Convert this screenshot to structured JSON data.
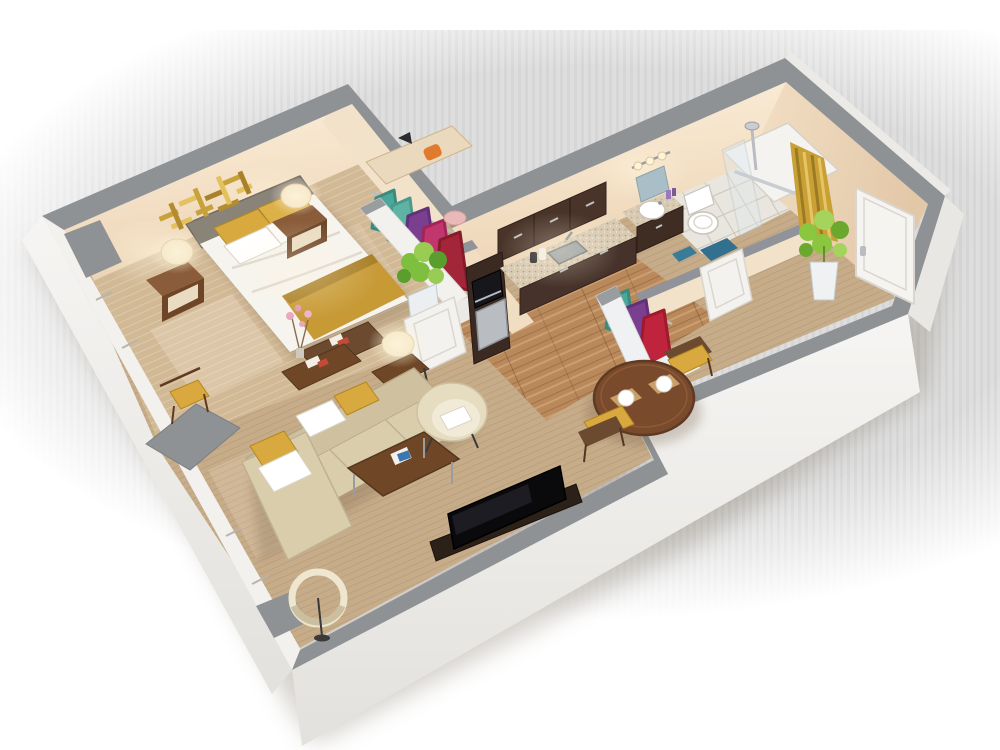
{
  "scene": {
    "type": "3d-floorplan-cutaway-render",
    "subject": "one-bedroom apartment isometric dollhouse view",
    "background": "soft vertical-striped light gray backdrop fading to white at edges",
    "view": "elevated three-quarter view from the south-east, walls cut low on viewer side"
  },
  "palette": {
    "wall_top_gray": "#8f9295",
    "wall_inner_cream": "#f6e7d2",
    "wall_outer_white": "#f2f0ed",
    "carpet_tan": "#c7ac89",
    "bedroom_carpet": "#d2b996",
    "wood_floor": "#b9895c",
    "bathroom_tile": "#e9e6df",
    "cabinet_espresso": "#402e25",
    "counter_speckled": "#d9cab2",
    "accent_gold": "#c9a23c",
    "duvet_white": "#f6f4ef",
    "headboard_gray": "#8a8378",
    "sofa_beige": "#d9cdac",
    "walnut_wood": "#6f4626",
    "lamp_cream": "#f3e3c2",
    "chair_mustard": "#d9a93f",
    "garment_teal": "#4aa89a",
    "garment_purple": "#7b3f8f",
    "garment_magenta": "#c2366e",
    "garment_crimson": "#a32638",
    "plant_green": "#7fbf3f",
    "bath_mat_blue": "#31708e",
    "shower_curtain_gold": "#c9a035"
  },
  "rooms": [
    {
      "name": "bedroom",
      "floor": "tan carpet with light weave",
      "furniture": [
        "queen bed with gray headboard, white duvet, gold runner, two gold and two white pillows",
        "left nightstand with cream table lamp",
        "right nightstand with cream table lamp",
        "gold abstract metal wall art above headboard",
        "walnut foot bench with books",
        "small desk stool with gold cushion by window",
        "vase of pink blossom branches"
      ]
    },
    {
      "name": "bedroom-closet",
      "furniture": [
        "cream shelf with orange handbag and black clutch",
        "clothes rail with teal, purple, magenta and crimson garments",
        "pink sun hat",
        "white half-height partitions",
        "potted green plant in white pot"
      ]
    },
    {
      "name": "living-room",
      "floor": "tan carpet",
      "furniture": [
        "beige L-shaped sectional sofa with chaise, white and gold pillows",
        "walnut coffee table with chrome legs and magazines",
        "cream barrel armchair with white pillow",
        "walnut side table with cream lamp",
        "walnut console with books",
        "flat-screen TV on dark media bench",
        "cream ring floor lamp in corner"
      ]
    },
    {
      "name": "kitchenette",
      "floor": "light oak plank wood",
      "furniture": [
        "espresso upper cabinets",
        "espresso base cabinets with speckled counter",
        "stainless undermount sink with faucet",
        "built-in black microwave",
        "stainless-front refrigerator drawer",
        "two canisters on counter"
      ]
    },
    {
      "name": "dining-nook",
      "floor": "tan carpet",
      "furniture": [
        "round walnut pedestal table",
        "two walnut chairs with mustard cushions",
        "two place settings with white plates on tan placemats"
      ]
    },
    {
      "name": "bathroom",
      "floor": "white tile with gray grout",
      "furniture": [
        "dark wood vanity with speckled top and round white basin",
        "mirror with three-light sconce bar",
        "white toilet",
        "walk-in shower with glass panel, chrome rain column and grab bar",
        "gold shower curtain",
        "blue bath mats",
        "purple toiletry bottles"
      ]
    },
    {
      "name": "entry-hall",
      "floor": "tan carpet",
      "furniture": [
        "white entry door on right wall",
        "white bathroom door",
        "open closet nook with teal, purple and crimson garments",
        "potted green plant in white pot"
      ]
    }
  ],
  "doors": [
    "bedroom door (white, ajar)",
    "bathroom door (white)",
    "entry door (white, on north-east wall)"
  ],
  "windows": [
    "bedroom window on south-west wall",
    "living room window on south-west wall"
  ],
  "lighting": [
    "warm glow from both nightstand lamps",
    "warm glow from living room side lamp",
    "sconce glow over bathroom mirror",
    "sunlight patches on bedroom and living room carpet"
  ]
}
